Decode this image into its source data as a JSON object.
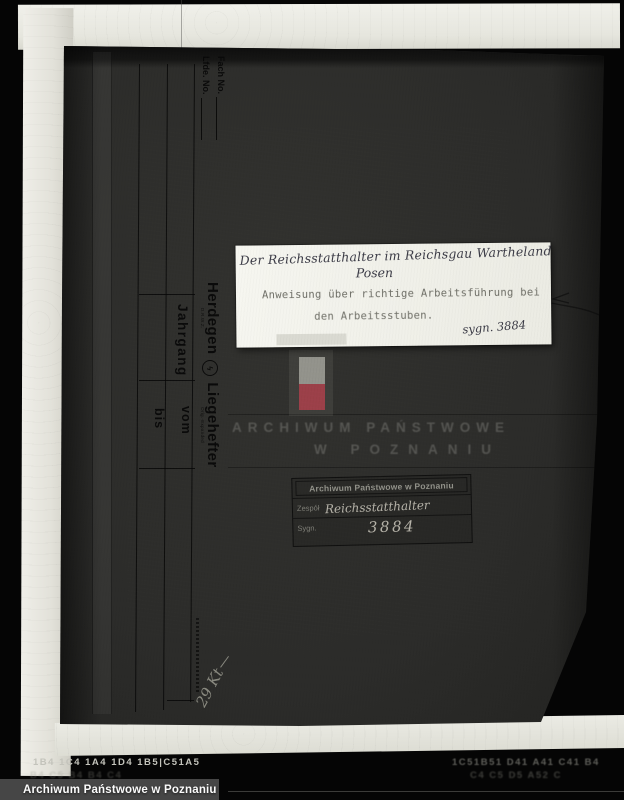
{
  "photo": {
    "watermark": "Archiwum Państwowe w Poznaniu",
    "film_codes": {
      "left_top": "1B4  1C4  1A4 1D4 1B5|C51A5",
      "right_top": "1C51B51 D41 A41 C41  B4",
      "left_bottom": "B4 C5 B4 B4 C4",
      "right_bottom": "C4 C5  D5 A52 C"
    }
  },
  "folder": {
    "fach_label": "Fach No.",
    "lfde_label": "Lfde. No.",
    "jahrgang_label": "Jahrgang",
    "vom_label": "vom",
    "bis_label": "bis",
    "brand": {
      "name1": "Herdegen",
      "trademark": "D.R.W.Z.",
      "logo_glyph": "ϟ",
      "name2": "Liegehefter",
      "subtext": "Orig.-Expanded"
    },
    "handwritten_note": "29 Kt"
  },
  "label": {
    "line1": "Der Reichsstatthalter im Reichsgau Wartheland",
    "line2": "Posen",
    "line3": "Anweisung über richtige Arbeitsführung bei",
    "line4": "den Arbeitsstuben.",
    "signature_note": "sygn. 3884"
  },
  "ghost_stamp": {
    "line1": "ARCHIWUM PAŃSTWOWE",
    "line2": "W POZNANIU"
  },
  "stamp": {
    "header": "Archiwum Państwowe w Poznaniu",
    "zespol_label": "Zespół",
    "zespol_value": "Reichsstatthalter",
    "sygn_label": "Sygn.",
    "sygn_value": "3884"
  },
  "colors": {
    "paper_label": "#f4f4ee",
    "folder_surface": "#2c2c2a",
    "flag_red": "#9c4049",
    "flag_white": "#93938c",
    "watermark_text": "#fbfbfb"
  }
}
